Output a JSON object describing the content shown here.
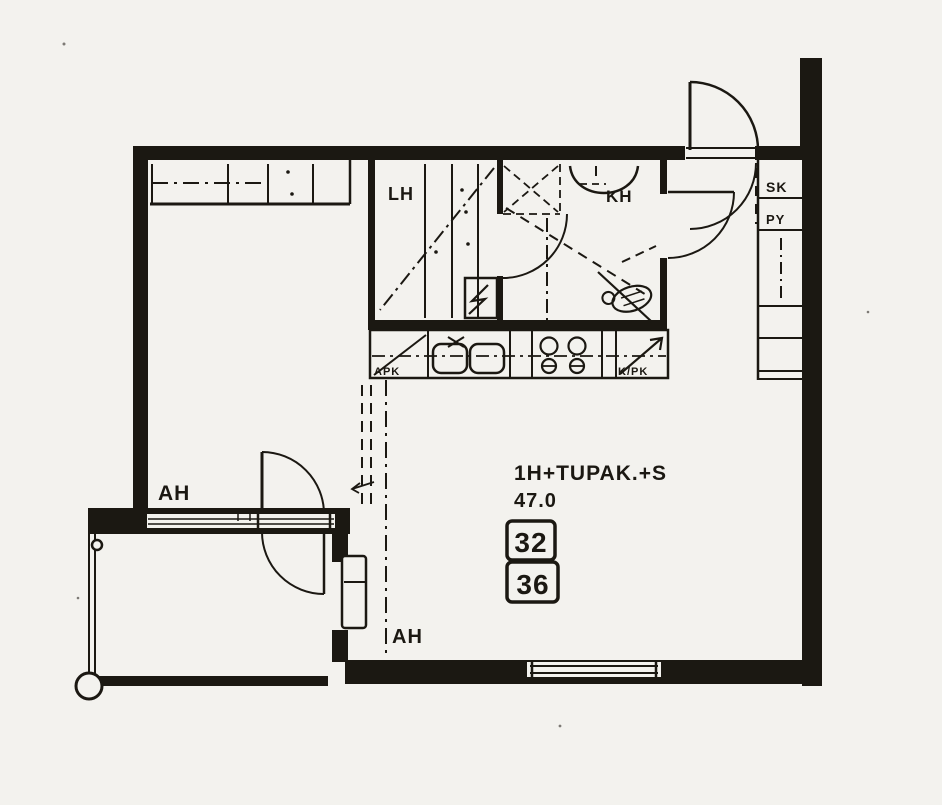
{
  "document": {
    "kind": "apartment-floor-plan-scan"
  },
  "colors": {
    "ink": "#1b1812",
    "paper": "#f3f2ee"
  },
  "apartment": {
    "layout_label": "1H+TUPAK.+S",
    "area_m2": "47.0",
    "unit_number_top": "32",
    "unit_number_bottom": "36"
  },
  "rooms": {
    "bedroom": "AH",
    "living": "AH",
    "sauna": "LH",
    "bathroom": "KH"
  },
  "closets": {
    "cleaning": "SK",
    "laundry": "PY"
  },
  "kitchen": {
    "dishwasher": "APK",
    "fridge_freezer": "K/PK"
  }
}
